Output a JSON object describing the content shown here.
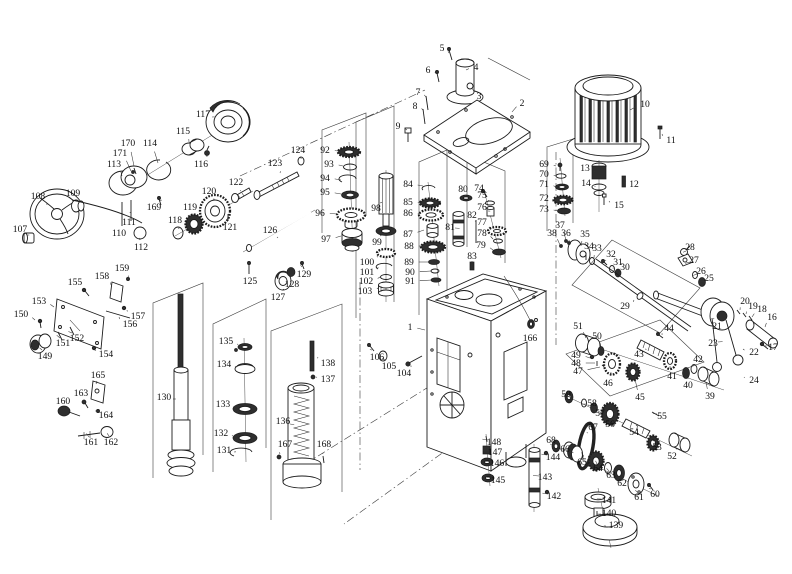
{
  "figure": {
    "background": "#ffffff",
    "ink_color": "#1c1c1c",
    "dark_fill": "#2e2e2e",
    "label_count": 171
  },
  "parts": [
    {
      "n": "1",
      "x": 410,
      "y": 327,
      "tx": 425,
      "ty": 330
    },
    {
      "n": "2",
      "x": 522,
      "y": 103,
      "tx": 512,
      "ty": 112
    },
    {
      "n": "3",
      "x": 479,
      "y": 96,
      "tx": 472,
      "ty": 88
    },
    {
      "n": "4",
      "x": 476,
      "y": 67,
      "tx": 466,
      "ty": 70
    },
    {
      "n": "5",
      "x": 442,
      "y": 48,
      "tx": 449,
      "ty": 53
    },
    {
      "n": "6",
      "x": 428,
      "y": 70,
      "tx": 437,
      "ty": 74
    },
    {
      "n": "7",
      "x": 418,
      "y": 92,
      "tx": 426,
      "ty": 97
    },
    {
      "n": "8",
      "x": 415,
      "y": 106,
      "tx": 423,
      "ty": 110
    },
    {
      "n": "9",
      "x": 398,
      "y": 126,
      "tx": 407,
      "ty": 130
    },
    {
      "n": "10",
      "x": 645,
      "y": 104,
      "tx": 630,
      "ty": 110
    },
    {
      "n": "11",
      "x": 671,
      "y": 140,
      "tx": 662,
      "ty": 134
    },
    {
      "n": "12",
      "x": 634,
      "y": 184,
      "tx": 626,
      "ty": 181
    },
    {
      "n": "13",
      "x": 585,
      "y": 168,
      "tx": 595,
      "ty": 172
    },
    {
      "n": "14",
      "x": 586,
      "y": 183,
      "tx": 595,
      "ty": 187
    },
    {
      "n": "15",
      "x": 619,
      "y": 205,
      "tx": 609,
      "ty": 201
    },
    {
      "n": "16",
      "x": 772,
      "y": 317,
      "tx": 765,
      "ty": 327
    },
    {
      "n": "17",
      "x": 773,
      "y": 347,
      "tx": 767,
      "ty": 346
    },
    {
      "n": "18",
      "x": 762,
      "y": 309,
      "tx": 752,
      "ty": 317
    },
    {
      "n": "19",
      "x": 753,
      "y": 306,
      "tx": 746,
      "ty": 314
    },
    {
      "n": "20",
      "x": 745,
      "y": 301,
      "tx": 740,
      "ty": 310
    },
    {
      "n": "21",
      "x": 717,
      "y": 326,
      "tx": 714,
      "ty": 318
    },
    {
      "n": "22",
      "x": 754,
      "y": 352,
      "tx": 743,
      "ty": 349
    },
    {
      "n": "23",
      "x": 713,
      "y": 343,
      "tx": 718,
      "ty": 342
    },
    {
      "n": "24",
      "x": 754,
      "y": 380,
      "tx": 744,
      "ty": 377
    },
    {
      "n": "25",
      "x": 709,
      "y": 278,
      "tx": 704,
      "ty": 281
    },
    {
      "n": "26",
      "x": 701,
      "y": 271,
      "tx": 697,
      "ty": 274
    },
    {
      "n": "27",
      "x": 694,
      "y": 260,
      "tx": 690,
      "ty": 262
    },
    {
      "n": "28",
      "x": 690,
      "y": 247,
      "tx": 686,
      "ty": 251
    },
    {
      "n": "29",
      "x": 625,
      "y": 306,
      "tx": 634,
      "ty": 300
    },
    {
      "n": "30",
      "x": 625,
      "y": 267,
      "tx": 621,
      "ty": 272
    },
    {
      "n": "31",
      "x": 618,
      "y": 262,
      "tx": 614,
      "ty": 268
    },
    {
      "n": "32",
      "x": 611,
      "y": 254,
      "tx": 606,
      "ty": 261
    },
    {
      "n": "33",
      "x": 597,
      "y": 248,
      "tx": 594,
      "ty": 258
    },
    {
      "n": "34",
      "x": 589,
      "y": 246,
      "tx": 587,
      "ty": 253
    },
    {
      "n": "35",
      "x": 585,
      "y": 234,
      "tx": 581,
      "ty": 246
    },
    {
      "n": "36",
      "x": 566,
      "y": 233,
      "tx": 569,
      "ty": 242
    },
    {
      "n": "37",
      "x": 560,
      "y": 225,
      "tx": 566,
      "ty": 240
    },
    {
      "n": "38",
      "x": 552,
      "y": 233,
      "tx": 560,
      "ty": 245
    },
    {
      "n": "39",
      "x": 710,
      "y": 396,
      "tx": 706,
      "ty": 382
    },
    {
      "n": "40",
      "x": 688,
      "y": 385,
      "tx": 686,
      "ty": 376
    },
    {
      "n": "41",
      "x": 672,
      "y": 376,
      "tx": 670,
      "ty": 366
    },
    {
      "n": "42",
      "x": 698,
      "y": 359,
      "tx": 694,
      "ty": 365
    },
    {
      "n": "43",
      "x": 639,
      "y": 354,
      "tx": 645,
      "ty": 349
    },
    {
      "n": "44",
      "x": 669,
      "y": 328,
      "tx": 662,
      "ty": 335
    },
    {
      "n": "45",
      "x": 640,
      "y": 397,
      "tx": 635,
      "ty": 379
    },
    {
      "n": "46",
      "x": 608,
      "y": 383,
      "tx": 611,
      "ty": 372
    },
    {
      "n": "47",
      "x": 578,
      "y": 371,
      "tx": 600,
      "ty": 367
    },
    {
      "n": "48",
      "x": 576,
      "y": 363,
      "tx": 595,
      "ty": 363
    },
    {
      "n": "49",
      "x": 576,
      "y": 355,
      "tx": 590,
      "ty": 358
    },
    {
      "n": "50",
      "x": 597,
      "y": 336,
      "tx": 600,
      "ty": 348
    },
    {
      "n": "51",
      "x": 578,
      "y": 326,
      "tx": 586,
      "ty": 338
    },
    {
      "n": "52",
      "x": 672,
      "y": 456,
      "tx": 676,
      "ty": 448
    },
    {
      "n": "53",
      "x": 657,
      "y": 447,
      "tx": 654,
      "ty": 441
    },
    {
      "n": "54",
      "x": 634,
      "y": 432,
      "tx": 636,
      "ty": 426
    },
    {
      "n": "55",
      "x": 662,
      "y": 416,
      "tx": 657,
      "ty": 414
    },
    {
      "n": "56",
      "x": 610,
      "y": 424,
      "tx": 610,
      "ty": 417
    },
    {
      "n": "57",
      "x": 600,
      "y": 413,
      "tx": 596,
      "ty": 410
    },
    {
      "n": "58",
      "x": 592,
      "y": 403,
      "tx": 586,
      "ty": 404
    },
    {
      "n": "59",
      "x": 566,
      "y": 394,
      "tx": 568,
      "ty": 396
    },
    {
      "n": "60",
      "x": 655,
      "y": 494,
      "tx": 651,
      "ty": 489
    },
    {
      "n": "61",
      "x": 639,
      "y": 497,
      "tx": 637,
      "ty": 492
    },
    {
      "n": "62",
      "x": 622,
      "y": 483,
      "tx": 620,
      "ty": 478
    },
    {
      "n": "63",
      "x": 611,
      "y": 475,
      "tx": 609,
      "ty": 471
    },
    {
      "n": "64",
      "x": 598,
      "y": 468,
      "tx": 597,
      "ty": 464
    },
    {
      "n": "65",
      "x": 582,
      "y": 462,
      "tx": 583,
      "ty": 457
    },
    {
      "n": "66",
      "x": 565,
      "y": 449,
      "tx": 570,
      "ty": 452
    },
    {
      "n": "67",
      "x": 593,
      "y": 427,
      "tx": 588,
      "ty": 433
    },
    {
      "n": "68",
      "x": 551,
      "y": 440,
      "tx": 555,
      "ty": 444
    },
    {
      "n": "69",
      "x": 544,
      "y": 164,
      "tx": 556,
      "ty": 166
    },
    {
      "n": "70",
      "x": 544,
      "y": 174,
      "tx": 556,
      "ty": 176
    },
    {
      "n": "71",
      "x": 544,
      "y": 184,
      "tx": 556,
      "ty": 187
    },
    {
      "n": "72",
      "x": 544,
      "y": 198,
      "tx": 554,
      "ty": 200
    },
    {
      "n": "73",
      "x": 544,
      "y": 209,
      "tx": 558,
      "ty": 211
    },
    {
      "n": "74",
      "x": 479,
      "y": 188,
      "tx": 484,
      "ty": 192
    },
    {
      "n": "75",
      "x": 482,
      "y": 195,
      "tx": 488,
      "ty": 201
    },
    {
      "n": "76",
      "x": 482,
      "y": 207,
      "tx": 488,
      "ty": 211
    },
    {
      "n": "77",
      "x": 482,
      "y": 222,
      "tx": 489,
      "ty": 228
    },
    {
      "n": "78",
      "x": 482,
      "y": 233,
      "tx": 493,
      "ty": 239
    },
    {
      "n": "79",
      "x": 481,
      "y": 245,
      "tx": 493,
      "ty": 250
    },
    {
      "n": "80",
      "x": 463,
      "y": 189,
      "tx": 465,
      "ty": 195
    },
    {
      "n": "81",
      "x": 450,
      "y": 227,
      "tx": 455,
      "ty": 228
    },
    {
      "n": "82",
      "x": 472,
      "y": 215,
      "tx": 475,
      "ty": 221
    },
    {
      "n": "83",
      "x": 472,
      "y": 256,
      "tx": 472,
      "ty": 261
    },
    {
      "n": "84",
      "x": 408,
      "y": 184,
      "tx": 423,
      "ty": 186
    },
    {
      "n": "85",
      "x": 408,
      "y": 202,
      "tx": 421,
      "ty": 203
    },
    {
      "n": "86",
      "x": 408,
      "y": 213,
      "tx": 420,
      "ty": 214
    },
    {
      "n": "87",
      "x": 408,
      "y": 234,
      "tx": 424,
      "ty": 230
    },
    {
      "n": "88",
      "x": 409,
      "y": 246,
      "tx": 422,
      "ty": 246
    },
    {
      "n": "89",
      "x": 409,
      "y": 262,
      "tx": 429,
      "ty": 262
    },
    {
      "n": "90",
      "x": 410,
      "y": 272,
      "tx": 431,
      "ty": 271
    },
    {
      "n": "91",
      "x": 410,
      "y": 281,
      "tx": 432,
      "ty": 280
    },
    {
      "n": "92",
      "x": 325,
      "y": 150,
      "tx": 338,
      "ty": 151
    },
    {
      "n": "93",
      "x": 329,
      "y": 164,
      "tx": 343,
      "ty": 166
    },
    {
      "n": "94",
      "x": 325,
      "y": 178,
      "tx": 341,
      "ty": 180
    },
    {
      "n": "95",
      "x": 325,
      "y": 192,
      "tx": 341,
      "ty": 194
    },
    {
      "n": "96",
      "x": 320,
      "y": 213,
      "tx": 337,
      "ty": 214
    },
    {
      "n": "97",
      "x": 326,
      "y": 239,
      "tx": 341,
      "ty": 236
    },
    {
      "n": "98",
      "x": 376,
      "y": 208,
      "tx": 380,
      "ty": 203
    },
    {
      "n": "99",
      "x": 377,
      "y": 242,
      "tx": 380,
      "ty": 236
    },
    {
      "n": "100",
      "x": 367,
      "y": 262,
      "tx": 377,
      "ty": 256
    },
    {
      "n": "101",
      "x": 367,
      "y": 272,
      "tx": 378,
      "ty": 267
    },
    {
      "n": "102",
      "x": 366,
      "y": 281,
      "tx": 380,
      "ty": 277
    },
    {
      "n": "103",
      "x": 365,
      "y": 291,
      "tx": 378,
      "ty": 288
    },
    {
      "n": "104",
      "x": 404,
      "y": 373,
      "tx": 410,
      "ty": 366
    },
    {
      "n": "105",
      "x": 389,
      "y": 366,
      "tx": 385,
      "ty": 360
    },
    {
      "n": "106",
      "x": 377,
      "y": 357,
      "tx": 372,
      "ty": 350
    },
    {
      "n": "107",
      "x": 20,
      "y": 229,
      "tx": 27,
      "ty": 235
    },
    {
      "n": "108",
      "x": 38,
      "y": 196,
      "tx": 47,
      "ty": 205
    },
    {
      "n": "109",
      "x": 73,
      "y": 193,
      "tx": 76,
      "ty": 200
    },
    {
      "n": "110",
      "x": 119,
      "y": 233,
      "tx": 122,
      "ty": 222
    },
    {
      "n": "111",
      "x": 129,
      "y": 222,
      "tx": 130,
      "ty": 212
    },
    {
      "n": "112",
      "x": 141,
      "y": 247,
      "tx": 140,
      "ty": 240
    },
    {
      "n": "113",
      "x": 114,
      "y": 164,
      "tx": 122,
      "ty": 176
    },
    {
      "n": "114",
      "x": 150,
      "y": 143,
      "tx": 158,
      "ty": 163
    },
    {
      "n": "115",
      "x": 183,
      "y": 131,
      "tx": 189,
      "ty": 142
    },
    {
      "n": "116",
      "x": 201,
      "y": 164,
      "tx": 206,
      "ty": 156
    },
    {
      "n": "117",
      "x": 203,
      "y": 114,
      "tx": 212,
      "ty": 117
    },
    {
      "n": "118",
      "x": 175,
      "y": 220,
      "tx": 178,
      "ty": 228
    },
    {
      "n": "119",
      "x": 190,
      "y": 207,
      "tx": 193,
      "ty": 216
    },
    {
      "n": "120",
      "x": 209,
      "y": 191,
      "tx": 213,
      "ty": 199
    },
    {
      "n": "121",
      "x": 230,
      "y": 227,
      "tx": 228,
      "ty": 219
    },
    {
      "n": "122",
      "x": 236,
      "y": 182,
      "tx": 240,
      "ty": 191
    },
    {
      "n": "123",
      "x": 275,
      "y": 163,
      "tx": 280,
      "ty": 173
    },
    {
      "n": "124",
      "x": 298,
      "y": 150,
      "tx": 300,
      "ty": 157
    },
    {
      "n": "125",
      "x": 250,
      "y": 281,
      "tx": 249,
      "ty": 272
    },
    {
      "n": "126",
      "x": 270,
      "y": 230,
      "tx": 277,
      "ty": 238
    },
    {
      "n": "127",
      "x": 278,
      "y": 297,
      "tx": 282,
      "ty": 290
    },
    {
      "n": "128",
      "x": 292,
      "y": 284,
      "tx": 291,
      "ty": 277
    },
    {
      "n": "129",
      "x": 304,
      "y": 274,
      "tx": 302,
      "ty": 267
    },
    {
      "n": "130",
      "x": 164,
      "y": 397,
      "tx": 173,
      "ty": 399
    },
    {
      "n": "131",
      "x": 224,
      "y": 450,
      "tx": 234,
      "ty": 452
    },
    {
      "n": "132",
      "x": 221,
      "y": 433,
      "tx": 232,
      "ty": 436
    },
    {
      "n": "133",
      "x": 223,
      "y": 404,
      "tx": 233,
      "ty": 407
    },
    {
      "n": "134",
      "x": 224,
      "y": 364,
      "tx": 235,
      "ty": 367
    },
    {
      "n": "135",
      "x": 226,
      "y": 341,
      "tx": 238,
      "ty": 345
    },
    {
      "n": "136",
      "x": 283,
      "y": 421,
      "tx": 290,
      "ty": 424
    },
    {
      "n": "137",
      "x": 328,
      "y": 379,
      "tx": 317,
      "ty": 377
    },
    {
      "n": "138",
      "x": 328,
      "y": 363,
      "tx": 318,
      "ty": 357
    },
    {
      "n": "139",
      "x": 616,
      "y": 525,
      "tx": 606,
      "ty": 526
    },
    {
      "n": "140",
      "x": 609,
      "y": 513,
      "tx": 601,
      "ty": 514
    },
    {
      "n": "141",
      "x": 609,
      "y": 500,
      "tx": 601,
      "ty": 499
    },
    {
      "n": "142",
      "x": 554,
      "y": 496,
      "tx": 548,
      "ty": 494
    },
    {
      "n": "143",
      "x": 545,
      "y": 477,
      "tx": 539,
      "ty": 476
    },
    {
      "n": "144",
      "x": 553,
      "y": 457,
      "tx": 547,
      "ty": 455
    },
    {
      "n": "145",
      "x": 498,
      "y": 480,
      "tx": 492,
      "ty": 478
    },
    {
      "n": "146",
      "x": 497,
      "y": 463,
      "tx": 491,
      "ty": 462
    },
    {
      "n": "147",
      "x": 495,
      "y": 452,
      "tx": 489,
      "ty": 451
    },
    {
      "n": "148",
      "x": 494,
      "y": 442,
      "tx": 488,
      "ty": 440
    },
    {
      "n": "149",
      "x": 45,
      "y": 356,
      "tx": 42,
      "ty": 350
    },
    {
      "n": "150",
      "x": 21,
      "y": 314,
      "tx": 35,
      "ty": 320
    },
    {
      "n": "151",
      "x": 63,
      "y": 343,
      "tx": 60,
      "ty": 338
    },
    {
      "n": "152",
      "x": 77,
      "y": 338,
      "tx": 72,
      "ty": 333
    },
    {
      "n": "153",
      "x": 39,
      "y": 301,
      "tx": 54,
      "ty": 307
    },
    {
      "n": "154",
      "x": 106,
      "y": 354,
      "tx": 96,
      "ty": 350
    },
    {
      "n": "155",
      "x": 75,
      "y": 282,
      "tx": 83,
      "ty": 291
    },
    {
      "n": "156",
      "x": 130,
      "y": 324,
      "tx": 119,
      "ty": 317
    },
    {
      "n": "157",
      "x": 138,
      "y": 316,
      "tx": 127,
      "ty": 310
    },
    {
      "n": "158",
      "x": 102,
      "y": 276,
      "tx": 111,
      "ty": 285
    },
    {
      "n": "159",
      "x": 122,
      "y": 268,
      "tx": 128,
      "ty": 277
    },
    {
      "n": "160",
      "x": 63,
      "y": 401,
      "tx": 64,
      "ty": 408
    },
    {
      "n": "161",
      "x": 91,
      "y": 442,
      "tx": 89,
      "ty": 437
    },
    {
      "n": "162",
      "x": 111,
      "y": 442,
      "tx": 109,
      "ty": 436
    },
    {
      "n": "163",
      "x": 81,
      "y": 393,
      "tx": 83,
      "ty": 400
    },
    {
      "n": "164",
      "x": 106,
      "y": 415,
      "tx": 100,
      "ty": 412
    },
    {
      "n": "165",
      "x": 98,
      "y": 375,
      "tx": 97,
      "ty": 381
    },
    {
      "n": "166",
      "x": 530,
      "y": 338,
      "tx": 530,
      "ty": 328
    },
    {
      "n": "167",
      "x": 285,
      "y": 444,
      "tx": 280,
      "ty": 454
    },
    {
      "n": "168",
      "x": 324,
      "y": 444,
      "tx": 323,
      "ty": 454
    },
    {
      "n": "169",
      "x": 154,
      "y": 207,
      "tx": 159,
      "ty": 201
    },
    {
      "n": "170",
      "x": 128,
      "y": 143,
      "tx": 134,
      "ty": 166
    },
    {
      "n": "171",
      "x": 120,
      "y": 153,
      "tx": 131,
      "ty": 171
    }
  ]
}
